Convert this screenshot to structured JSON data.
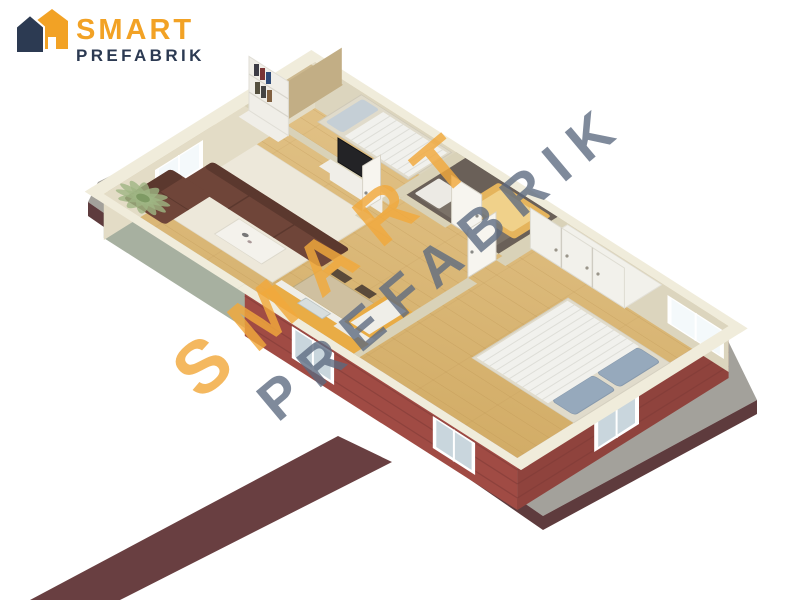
{
  "page": {
    "background": "#FFFFFF",
    "width": 800,
    "height": 600
  },
  "logo": {
    "icon": "house-icon",
    "text_primary": "SMART",
    "text_secondary": "PREFABRIK",
    "color_primary": "#F2A225",
    "color_secondary": "#2C3A52"
  },
  "watermark": {
    "text_primary": "SMART",
    "text_secondary": "PREFABRIK",
    "color_primary": "#F2A93C",
    "color_secondary": "#5C6A80",
    "opacity_primary": "0.82",
    "opacity_secondary": "0.78",
    "rotation_deg": -40
  },
  "scene": {
    "kind": "isometric-3d-floor-plan-render",
    "description": "Cutaway bird's-eye render of a single-storey prefabricated house: living room with brown corner sofa, coffee table, TV unit, bookshelf and palm plant; kitchen-dining area with yellow counters and dining table; small bedroom with single bed and wardrobe; dark tiled bathroom with tub; master bedroom with double bed and fitted closet; red brick exterior walls on a grey concrete slab with a dark red walkway.",
    "colors": {
      "floor_wood_light": "#E3C48A",
      "floor_wood": "#D2AC66",
      "floor_line": "#B8904E",
      "rug": "#EDE8DA",
      "wall_top": "#F0ECDB",
      "wall_band": "#D9D2B8",
      "wall_interior": "#E3DCC6",
      "wall_interior2": "#DCD5BE",
      "wall_exterior_left": "#A7B0A0",
      "brick_red": "#A04B44",
      "brick_line": "#7E3A36",
      "slab": "#A3A19B",
      "slab_edge": "#5E3B3D",
      "walkway": "#693F41",
      "sofa": "#6F4539",
      "sofa_dark": "#5B382E",
      "coffee_table": "#F4F2EC",
      "plant": "#9FB583",
      "plant_dark": "#7E9A64",
      "tv_screen": "#232326",
      "shelf_white": "#F0EEE8",
      "bathroom_tile": "#6A6058",
      "bathroom_floor": "#7B7268",
      "bathtub": "#E5B45C",
      "bathtub_inner": "#F0D18A",
      "fixture_white": "#ECEAE4",
      "kitchen_cabinet": "#E9AC45",
      "counter_white": "#EFEEE8",
      "sink_steel": "#D8DEDE",
      "dining_table": "#CFC0A0",
      "chair_dark": "#5A4A3A",
      "chair_light": "#7A6A50",
      "bed_frame": "#E0DBCB",
      "bed_duvet": "#F1F1ED",
      "bed_crinkle": "#DEDED8",
      "bed_pillow": "#96A9BC",
      "pillow_light": "#C5CFD6",
      "wardrobe_tan": "#CDB990",
      "wardrobe_tan_dark": "#C2AE85",
      "closet_white": "#F2F1EB",
      "door_white": "#F7F5EF",
      "window_frame": "#FFFFFF",
      "window_glass": "#F4F9FB",
      "window_glass_tinted": "#C9D6DD"
    },
    "rooms": [
      {
        "id": "living-room",
        "items": [
          "corner-sofa",
          "coffee-table",
          "area-rug",
          "tv",
          "tv-unit",
          "bookshelf",
          "palm-plant",
          "window"
        ]
      },
      {
        "id": "kitchen-dining",
        "items": [
          "dining-table",
          "chairs",
          "kitchen-counter",
          "sink",
          "window"
        ]
      },
      {
        "id": "small-bedroom",
        "items": [
          "single-bed",
          "wardrobe",
          "window"
        ]
      },
      {
        "id": "bathroom",
        "items": [
          "bathtub",
          "washbasin",
          "door"
        ]
      },
      {
        "id": "hallway",
        "items": [
          "door",
          "door",
          "door"
        ]
      },
      {
        "id": "master-bedroom",
        "items": [
          "double-bed",
          "pillows",
          "fitted-closet",
          "window",
          "window"
        ]
      }
    ],
    "exterior": {
      "items": [
        "concrete-slab",
        "dark-red-walkway",
        "red-brick-walls",
        "slab-edge"
      ]
    }
  }
}
